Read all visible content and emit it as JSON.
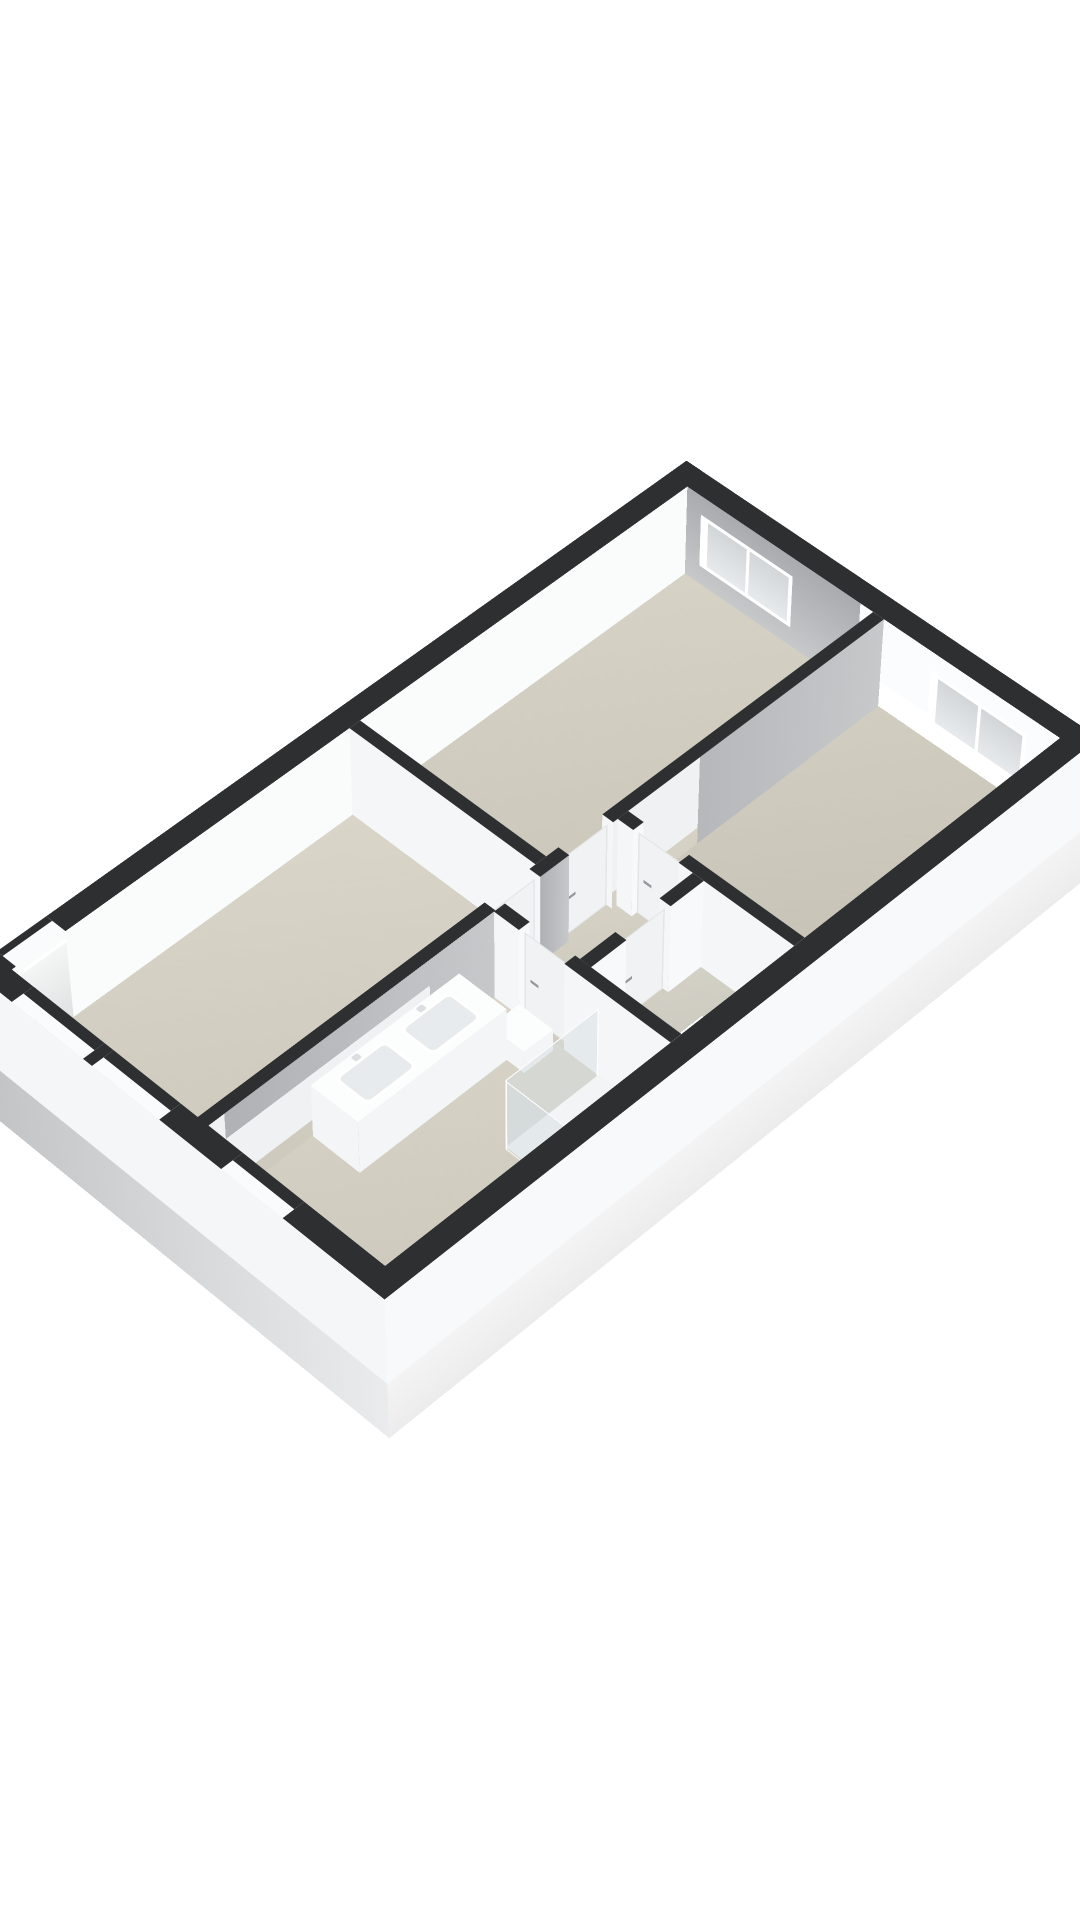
{
  "meta": {
    "kind": "3d-floorplan-cutaway-render",
    "text_labels_visible": "none"
  },
  "scene": {
    "canvas_w": 1080,
    "canvas_h": 1920,
    "world_left": 684,
    "world_top": 548,
    "rotate_x_deg": 41.5,
    "rotate_z_deg": 44.7,
    "perspective_px": 5500,
    "perspective_origin": "535px 940px"
  },
  "palette": {
    "background": "#ffffff",
    "darkTop": "#2e2f31",
    "sill": "#fafbfc",
    "neInner": "linear-gradient(to bottom,#c6c8ca,#a9abae)",
    "nwInner": "#fafbfb",
    "grayFace": "linear-gradient(to bottom,#c6c8ca,#aeb0b3)",
    "faceN": "#fbfcfd",
    "faceS": "#f5f6f7",
    "faceW": "#f0f1f2",
    "faceE": "#f8f9fa",
    "skirtSE": "linear-gradient(to right,#ececed,#ffffff)",
    "skirtSW": "linear-gradient(to right,#c2c3c5,#eaebec)",
    "skirtNW": "linear-gradient(to bottom,#cfd0d1,#c0c1c3)",
    "floorSlab": "linear-gradient(125deg,#ddd9cc,#c9c5b8)",
    "glass": "linear-gradient(to bottom,#e7eaec,#d2d6d9)",
    "showerGlass": "rgba(213,221,226,0.5)",
    "showerRail": "#fdfdfd",
    "doorSlab": "#f1f2f3",
    "handle": "#94999c",
    "fixtureTop": "#fcfdfd",
    "fixtureSide": "#f3f5f6",
    "fixtureSideDim": "#e9ebec",
    "sinkBasin": "#e8ebed"
  },
  "building": {
    "outer_w": 535,
    "outer_l": 936,
    "ext_wall": 26,
    "int_wall": 14,
    "cut_height": 120,
    "skirt_z0": -80,
    "skirt_height": 200
  },
  "floor": {
    "slab": {
      "x": 26,
      "y": 26,
      "w": 483,
      "d": 884
    }
  },
  "rooms": [
    {
      "id": "bedroom-1",
      "x": 26,
      "y": 26,
      "w": 246,
      "d": 446,
      "tint": "#d6d2c5"
    },
    {
      "id": "bedroom-2",
      "x": 286,
      "y": 26,
      "w": 223,
      "d": 352,
      "tint": "#d1cdc0"
    },
    {
      "id": "hall",
      "x": 286,
      "y": 392,
      "w": 96,
      "d": 148,
      "tint": "#d5d1c4"
    },
    {
      "id": "toilet-room",
      "x": 396,
      "y": 392,
      "w": 113,
      "d": 148,
      "tint": "#d3d0c6"
    },
    {
      "id": "bathroom",
      "x": 286,
      "y": 554,
      "w": 223,
      "d": 356,
      "tint": "#d8d4c7"
    },
    {
      "id": "living-room",
      "x": 26,
      "y": 486,
      "w": 246,
      "d": 424,
      "tint": "#d9d5c8"
    }
  ],
  "walls": [
    {
      "id": "ext-ne",
      "x": 0,
      "y": 0,
      "w": 535,
      "d": 26,
      "top": false,
      "faces": {
        "s": "neInner"
      }
    },
    {
      "id": "ext-nw",
      "x": 0,
      "y": 0,
      "w": 26,
      "d": 936,
      "top": false,
      "faces": {
        "e": "nwInner"
      }
    },
    {
      "id": "ext-sw",
      "x": 0,
      "y": 910,
      "w": 535,
      "d": 26,
      "top": false,
      "faces": {}
    },
    {
      "id": "ext-se",
      "x": 509,
      "y": 0,
      "w": 26,
      "d": 936,
      "top": false,
      "faces": {}
    },
    {
      "id": "int-v1-a",
      "x": 272,
      "y": 26,
      "w": 14,
      "d": 372,
      "top": true,
      "faces": {
        "e": "grayFace"
      }
    },
    {
      "id": "int-v1-b",
      "x": 272,
      "y": 456,
      "w": 14,
      "d": 38,
      "top": true,
      "faces": {
        "e": "grayFace"
      }
    },
    {
      "id": "int-v1-c",
      "x": 272,
      "y": 552,
      "w": 14,
      "d": 360,
      "top": true,
      "faces": {
        "e": "grayFace"
      }
    },
    {
      "id": "int-h2",
      "x": 26,
      "y": 472,
      "w": 246,
      "d": 14,
      "top": true,
      "faces": {}
    },
    {
      "id": "int-h1-a",
      "x": 286,
      "y": 378,
      "w": 20,
      "d": 14,
      "top": true,
      "faces": {}
    },
    {
      "id": "int-h1-b",
      "x": 364,
      "y": 378,
      "w": 145,
      "d": 14,
      "top": true,
      "faces": {}
    },
    {
      "id": "int-v2-a",
      "x": 382,
      "y": 392,
      "w": 14,
      "d": 44,
      "top": true,
      "faces": {}
    },
    {
      "id": "int-v2-b",
      "x": 382,
      "y": 494,
      "w": 14,
      "d": 46,
      "top": true,
      "faces": {}
    },
    {
      "id": "int-h3-a",
      "x": 286,
      "y": 540,
      "w": 32,
      "d": 14,
      "top": true,
      "faces": {}
    },
    {
      "id": "int-h3-b",
      "x": 376,
      "y": 540,
      "w": 133,
      "d": 14,
      "top": true,
      "faces": {}
    }
  ],
  "top_segments": [
    {
      "id": "ne-top-1",
      "x": 0,
      "y": 0,
      "w": 535,
      "d": 26,
      "color": "darkTop"
    },
    {
      "id": "nw-top-1",
      "x": 0,
      "y": 0,
      "w": 26,
      "d": 845,
      "color": "darkTop"
    },
    {
      "id": "nw-top-2",
      "x": 0,
      "y": 905,
      "w": 26,
      "d": 31,
      "color": "darkTop"
    },
    {
      "id": "nw-top-door-outer",
      "x": 0,
      "y": 845,
      "w": 8,
      "d": 60,
      "color": "darkTop"
    },
    {
      "id": "nw-top-door-sill",
      "x": 8,
      "y": 845,
      "w": 18,
      "d": 60,
      "color": "sill"
    },
    {
      "id": "sw-top-1",
      "x": 0,
      "y": 910,
      "w": 55,
      "d": 26,
      "color": "darkTop"
    },
    {
      "id": "sw-top-2",
      "x": 150,
      "y": 910,
      "w": 12,
      "d": 26,
      "color": "darkTop"
    },
    {
      "id": "sw-top-3",
      "x": 250,
      "y": 910,
      "w": 80,
      "d": 26,
      "color": "darkTop"
    },
    {
      "id": "sw-top-4",
      "x": 408,
      "y": 910,
      "w": 127,
      "d": 26,
      "color": "darkTop"
    },
    {
      "id": "sw-sill-1",
      "x": 55,
      "y": 910,
      "w": 95,
      "d": 12,
      "color": "darkTop"
    },
    {
      "id": "sw-sill-1b",
      "x": 55,
      "y": 922,
      "w": 95,
      "d": 14,
      "color": "sill"
    },
    {
      "id": "sw-sill-2",
      "x": 162,
      "y": 910,
      "w": 88,
      "d": 12,
      "color": "darkTop"
    },
    {
      "id": "sw-sill-2b",
      "x": 162,
      "y": 922,
      "w": 88,
      "d": 14,
      "color": "sill"
    },
    {
      "id": "sw-sill-3",
      "x": 330,
      "y": 910,
      "w": 78,
      "d": 12,
      "color": "darkTop"
    },
    {
      "id": "sw-sill-3b",
      "x": 330,
      "y": 922,
      "w": 78,
      "d": 14,
      "color": "sill"
    },
    {
      "id": "se-top-1",
      "x": 509,
      "y": 0,
      "w": 26,
      "d": 936,
      "color": "darkTop"
    }
  ],
  "skirts": [
    {
      "id": "skirt-se",
      "type": "x",
      "x": 535,
      "y": 0,
      "len": 936,
      "color": "skirtSE",
      "panels": []
    },
    {
      "id": "skirt-nw",
      "type": "x",
      "x": 0,
      "y": 0,
      "len": 936,
      "color": "skirtNW",
      "panels": []
    },
    {
      "id": "skirt-sw",
      "type": "y",
      "x": 0,
      "y": 936,
      "len": 535,
      "color": "skirtSW",
      "panels": [
        {
          "id": "window-living-1-ext",
          "left": 55,
          "top": 105,
          "w": 95,
          "h": 80
        },
        {
          "id": "window-living-2-ext",
          "left": 162,
          "top": 105,
          "w": 88,
          "h": 80
        },
        {
          "id": "window-bathroom-ext",
          "left": 330,
          "top": 110,
          "w": 78,
          "h": 70
        }
      ]
    }
  ],
  "ne_windows": [
    {
      "id": "window-bedroom-1",
      "x0": 45,
      "x1": 168,
      "top": 25,
      "height": 70
    },
    {
      "id": "window-bedroom-2",
      "x0": 348,
      "x1": 470,
      "top": 25,
      "height": 70
    }
  ],
  "entrance": {
    "id": "entrance-door-recess",
    "y0": 845,
    "y1": 905,
    "depth": 110
  },
  "doors": [
    {
      "id": "door-bedroom-1",
      "axis": "x",
      "at": 279,
      "from": 398,
      "to": 456
    },
    {
      "id": "door-living-hall",
      "axis": "x",
      "at": 279,
      "from": 494,
      "to": 552
    },
    {
      "id": "door-bedroom-2",
      "axis": "y",
      "at": 385,
      "from": 306,
      "to": 364
    },
    {
      "id": "door-toilet",
      "axis": "x",
      "at": 389,
      "from": 436,
      "to": 494
    },
    {
      "id": "door-bathroom",
      "axis": "y",
      "at": 547,
      "from": 318,
      "to": 376
    }
  ],
  "fixtures": {
    "vanity": {
      "id": "vanity-double-sink",
      "x": 286.5,
      "y": 600,
      "w": 61,
      "d": 188,
      "h": 72,
      "basins": [
        {
          "left": 9,
          "top": 22,
          "w": 44,
          "h": 64
        },
        {
          "left": 9,
          "top": 104,
          "w": 44,
          "h": 64
        }
      ]
    },
    "shower": {
      "tray": {
        "x": 422,
        "y": 556,
        "w": 85,
        "d": 120
      },
      "glass_h": 98
    },
    "toilet": {
      "tank": {
        "x": 468,
        "y": 468,
        "w": 38,
        "d": 30,
        "h": 52
      },
      "bowl": {
        "x": 473,
        "y": 436,
        "w": 28,
        "d": 32,
        "h": 30
      }
    },
    "step": {
      "x": 326,
      "y": 562,
      "w": 44,
      "d": 38,
      "h": 30
    }
  }
}
